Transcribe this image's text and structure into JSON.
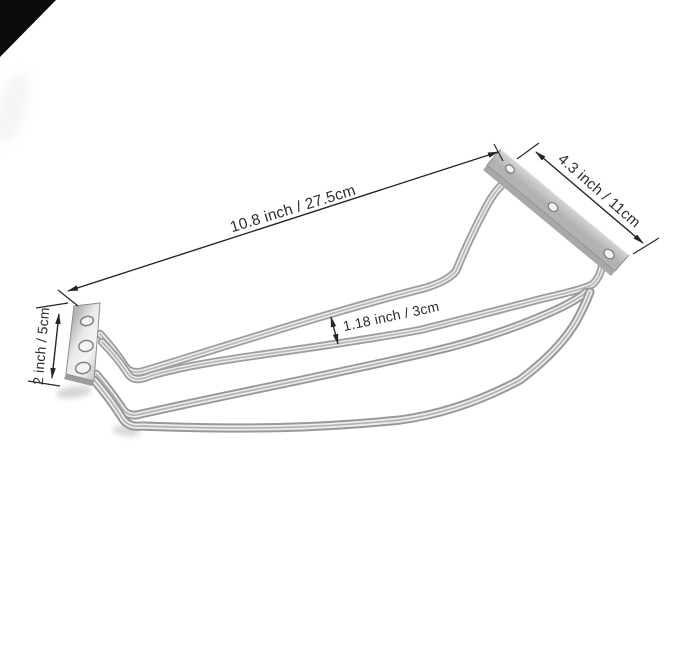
{
  "scene": {
    "background_color": "#ffffff",
    "corner_triangle_color": "#0b0b0b"
  },
  "measurements": [
    {
      "id": "rail-length",
      "label": "10.8 inch / 27.5cm",
      "inches": 10.8,
      "cm": 27.5,
      "position": "top-diagonal"
    },
    {
      "id": "bracket-length",
      "label": "4.3 inch / 11cm",
      "inches": 4.3,
      "cm": 11,
      "position": "right-diagonal"
    },
    {
      "id": "bracket-height",
      "label": "2 inch / 5cm",
      "inches": 2,
      "cm": 5,
      "position": "left-vertical"
    },
    {
      "id": "rail-gap",
      "label": "1.18 inch / 3cm",
      "inches": 1.18,
      "cm": 3,
      "position": "center-gap"
    }
  ],
  "colors": {
    "dimension_line": "#262626",
    "label_text": "#2d2d2d",
    "metal_highlight": "#f2f2f2",
    "metal_mid": "#c9c9c9",
    "metal_shadow": "#9a9a9a"
  }
}
